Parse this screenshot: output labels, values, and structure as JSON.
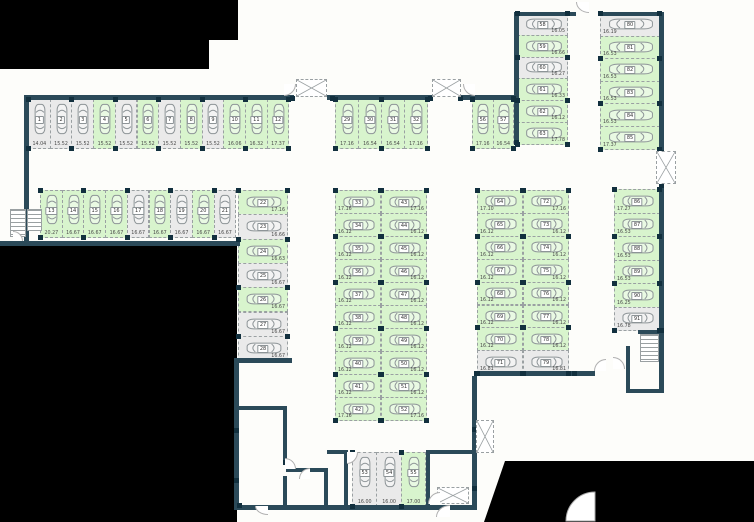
{
  "colors": {
    "available": "#d8f4cd",
    "occupied": "#eaeaea",
    "wall": "#2b4a59",
    "pillar": "#12303e",
    "outside": "#000000",
    "floor": "#fdfdfa"
  },
  "groups": [
    {
      "id": "top-row",
      "label": "Spaces 1-12",
      "spaces": [
        {
          "n": "1",
          "area": "14.04",
          "status": "occupied"
        },
        {
          "n": "2",
          "area": "15.52",
          "status": "occupied"
        },
        {
          "n": "3",
          "area": "15.52",
          "status": "occupied"
        },
        {
          "n": "4",
          "area": "15.52",
          "status": "available"
        },
        {
          "n": "5",
          "area": "15.52",
          "status": "occupied"
        },
        {
          "n": "6",
          "area": "15.52",
          "status": "available"
        },
        {
          "n": "7",
          "area": "15.52",
          "status": "occupied"
        },
        {
          "n": "8",
          "area": "15.52",
          "status": "available"
        },
        {
          "n": "9",
          "area": "15.52",
          "status": "occupied"
        },
        {
          "n": "10",
          "area": "16.06",
          "status": "available"
        },
        {
          "n": "11",
          "area": "16.32",
          "status": "available"
        },
        {
          "n": "12",
          "area": "17.37",
          "status": "available"
        }
      ]
    },
    {
      "id": "second-row",
      "label": "Spaces 13-21",
      "spaces": [
        {
          "n": "13",
          "area": "20.27",
          "status": "available"
        },
        {
          "n": "14",
          "area": "16.67",
          "status": "available"
        },
        {
          "n": "15",
          "area": "16.67",
          "status": "available"
        },
        {
          "n": "16",
          "area": "16.67",
          "status": "available"
        },
        {
          "n": "17",
          "area": "16.67",
          "status": "occupied"
        },
        {
          "n": "18",
          "area": "16.67",
          "status": "available"
        },
        {
          "n": "19",
          "area": "16.67",
          "status": "occupied"
        },
        {
          "n": "20",
          "area": "16.67",
          "status": "available"
        },
        {
          "n": "21",
          "area": "16.67",
          "status": "occupied"
        }
      ]
    },
    {
      "id": "west-column",
      "label": "Spaces 22-28",
      "spaces": [
        {
          "n": "22",
          "area": "17.16",
          "status": "available"
        },
        {
          "n": "23",
          "area": "16.66",
          "status": "occupied"
        },
        {
          "n": "24",
          "area": "16.63",
          "status": "available"
        },
        {
          "n": "25",
          "area": "16.67",
          "status": "occupied"
        },
        {
          "n": "26",
          "area": "16.67",
          "status": "available"
        },
        {
          "n": "27",
          "area": "16.67",
          "status": "occupied"
        },
        {
          "n": "28",
          "area": "16.67",
          "status": "occupied"
        }
      ]
    },
    {
      "id": "mid-top-row",
      "label": "Spaces 29-32",
      "spaces": [
        {
          "n": "29",
          "area": "17.16",
          "status": "available"
        },
        {
          "n": "30",
          "area": "16.54",
          "status": "available"
        },
        {
          "n": "31",
          "area": "16.54",
          "status": "available"
        },
        {
          "n": "32",
          "area": "17.16",
          "status": "available"
        }
      ]
    },
    {
      "id": "center-col-left",
      "label": "Spaces 33-42",
      "spaces": [
        {
          "n": "33",
          "area": "17.16",
          "status": "available"
        },
        {
          "n": "34",
          "area": "16.12",
          "status": "available"
        },
        {
          "n": "35",
          "area": "16.12",
          "status": "available"
        },
        {
          "n": "36",
          "area": "16.12",
          "status": "available"
        },
        {
          "n": "37",
          "area": "16.12",
          "status": "available"
        },
        {
          "n": "38",
          "area": "16.12",
          "status": "available"
        },
        {
          "n": "39",
          "area": "16.12",
          "status": "available"
        },
        {
          "n": "40",
          "area": "16.12",
          "status": "available"
        },
        {
          "n": "41",
          "area": "16.12",
          "status": "available"
        },
        {
          "n": "42",
          "area": "17.16",
          "status": "available"
        }
      ]
    },
    {
      "id": "center-col-right",
      "label": "Spaces 43-52",
      "spaces": [
        {
          "n": "43",
          "area": "17.16",
          "status": "available"
        },
        {
          "n": "44",
          "area": "16.12",
          "status": "available"
        },
        {
          "n": "45",
          "area": "16.12",
          "status": "available"
        },
        {
          "n": "46",
          "area": "16.12",
          "status": "available"
        },
        {
          "n": "47",
          "area": "16.12",
          "status": "available"
        },
        {
          "n": "48",
          "area": "16.12",
          "status": "available"
        },
        {
          "n": "49",
          "area": "16.12",
          "status": "available"
        },
        {
          "n": "50",
          "area": "16.12",
          "status": "available"
        },
        {
          "n": "51",
          "area": "16.12",
          "status": "available"
        },
        {
          "n": "52",
          "area": "17.16",
          "status": "available"
        }
      ]
    },
    {
      "id": "south-garage",
      "label": "Spaces 53-55",
      "spaces": [
        {
          "n": "53",
          "area": "16.00",
          "status": "occupied"
        },
        {
          "n": "54",
          "area": "16.00",
          "status": "occupied"
        },
        {
          "n": "55",
          "area": "17.00",
          "status": "available"
        }
      ]
    },
    {
      "id": "mid-top-pair",
      "label": "Spaces 56-57",
      "spaces": [
        {
          "n": "56",
          "area": "17.16",
          "status": "available"
        },
        {
          "n": "57",
          "area": "16.54",
          "status": "available"
        }
      ]
    },
    {
      "id": "ne-col-left",
      "label": "Spaces 58-63",
      "spaces": [
        {
          "n": "58",
          "area": "16.05",
          "status": "occupied"
        },
        {
          "n": "59",
          "area": "16.66",
          "status": "available"
        },
        {
          "n": "60",
          "area": "16.27",
          "status": "occupied"
        },
        {
          "n": "61",
          "area": "16.33",
          "status": "available"
        },
        {
          "n": "62",
          "area": "16.12",
          "status": "available"
        },
        {
          "n": "63",
          "area": "17.78",
          "status": "available"
        }
      ]
    },
    {
      "id": "east-col-left",
      "label": "Spaces 64-71",
      "spaces": [
        {
          "n": "64",
          "area": "17.10",
          "status": "available"
        },
        {
          "n": "65",
          "area": "16.12",
          "status": "available"
        },
        {
          "n": "66",
          "area": "16.12",
          "status": "available"
        },
        {
          "n": "67",
          "area": "16.12",
          "status": "available"
        },
        {
          "n": "68",
          "area": "16.12",
          "status": "available"
        },
        {
          "n": "69",
          "area": "16.12",
          "status": "available"
        },
        {
          "n": "70",
          "area": "16.12",
          "status": "available"
        },
        {
          "n": "71",
          "area": "16.81",
          "status": "occupied"
        }
      ]
    },
    {
      "id": "east-col-right",
      "label": "Spaces 72-79",
      "spaces": [
        {
          "n": "72",
          "area": "17.16",
          "status": "available"
        },
        {
          "n": "73",
          "area": "16.12",
          "status": "available"
        },
        {
          "n": "74",
          "area": "16.12",
          "status": "available"
        },
        {
          "n": "75",
          "area": "16.12",
          "status": "available"
        },
        {
          "n": "76",
          "area": "16.12",
          "status": "available"
        },
        {
          "n": "77",
          "area": "16.12",
          "status": "available"
        },
        {
          "n": "78",
          "area": "16.12",
          "status": "available"
        },
        {
          "n": "79",
          "area": "16.81",
          "status": "occupied"
        }
      ]
    },
    {
      "id": "ne-col-right",
      "label": "Spaces 80-85",
      "spaces": [
        {
          "n": "80",
          "area": "16.19",
          "status": "occupied"
        },
        {
          "n": "81",
          "area": "16.53",
          "status": "available"
        },
        {
          "n": "82",
          "area": "16.53",
          "status": "available"
        },
        {
          "n": "83",
          "area": "16.53",
          "status": "available"
        },
        {
          "n": "84",
          "area": "16.53",
          "status": "available"
        },
        {
          "n": "85",
          "area": "17.37",
          "status": "available"
        }
      ]
    },
    {
      "id": "far-east-col",
      "label": "Spaces 86-91",
      "spaces": [
        {
          "n": "86",
          "area": "17.27",
          "status": "available"
        },
        {
          "n": "87",
          "area": "16.53",
          "status": "available"
        },
        {
          "n": "88",
          "area": "16.53",
          "status": "available"
        },
        {
          "n": "89",
          "area": "16.53",
          "status": "available"
        },
        {
          "n": "90",
          "area": "16.25",
          "status": "available"
        },
        {
          "n": "91",
          "area": "16.78",
          "status": "occupied"
        }
      ]
    }
  ]
}
